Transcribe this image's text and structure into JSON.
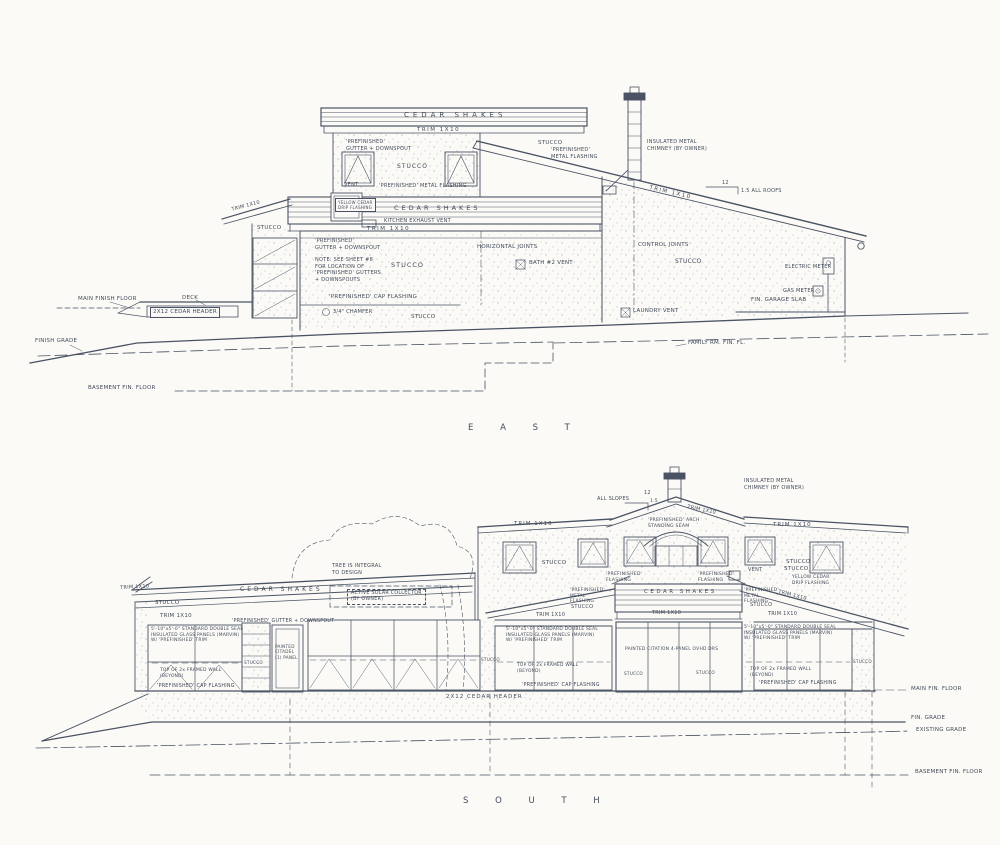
{
  "colors": {
    "paper": "#fbfaf7",
    "ink": "#4a5363",
    "text": "#424b59"
  },
  "titles": {
    "east": "E A S T",
    "south": "S O U T H"
  },
  "east": {
    "labels": [
      {
        "id": "cedar-shakes-upper",
        "t": "CEDAR SHAKES",
        "x": 404,
        "y": 111,
        "fs": 7,
        "ls": 4
      },
      {
        "id": "trim-1x10-upper",
        "t": "TRIM 1X10",
        "x": 417,
        "y": 127,
        "fs": 5.5,
        "ls": 1.5
      },
      {
        "id": "gutter-downspout-clerestory",
        "t": "'PREFINISHED'\nGUTTER + DOWNSPOUT",
        "x": 346,
        "y": 139,
        "fs": 5
      },
      {
        "id": "stucco-clerestory",
        "t": "STUCCO",
        "x": 397,
        "y": 163,
        "fs": 6,
        "ls": 1
      },
      {
        "id": "stucco-shed",
        "t": "STUCCO",
        "x": 538,
        "y": 140,
        "fs": 5.5
      },
      {
        "id": "metal-flashing-shed",
        "t": "'PREFINISHED'\nMETAL FLASHING",
        "x": 551,
        "y": 147,
        "fs": 5
      },
      {
        "id": "chimney-note",
        "t": "INSULATED METAL\nCHIMNEY (BY OWNER)",
        "x": 647,
        "y": 139,
        "fs": 5
      },
      {
        "id": "vent-clerestory",
        "t": "VENT",
        "x": 344,
        "y": 182,
        "fs": 5
      },
      {
        "id": "metal-flashing-band",
        "t": "'PREFINISHED' METAL FLASHING",
        "x": 379,
        "y": 183,
        "fs": 5
      },
      {
        "id": "trim-1x10-shed",
        "t": "TRIM 1X10",
        "x": 650,
        "y": 185,
        "fs": 5.5,
        "ls": 1.5,
        "r": 13
      },
      {
        "id": "slope-run",
        "t": "12",
        "x": 722,
        "y": 180,
        "fs": 5
      },
      {
        "id": "slope-note",
        "t": "1.5 ALL ROOFS",
        "x": 741,
        "y": 188,
        "fs": 5
      },
      {
        "id": "yellow-cedar-flashing",
        "t": "YELLOW CEDAR\nDRIP FLASHING",
        "x": 335,
        "y": 198,
        "fs": 4,
        "box": "solid"
      },
      {
        "id": "cedar-shakes-mid",
        "t": "CEDAR SHAKES",
        "x": 394,
        "y": 204,
        "fs": 6.5,
        "ls": 3
      },
      {
        "id": "kitchen-exhaust-vent",
        "t": "KITCHEN EXHAUST VENT",
        "x": 384,
        "y": 218,
        "fs": 5
      },
      {
        "id": "trim-1x10-mid",
        "t": "TRIM 1X10",
        "x": 367,
        "y": 226,
        "fs": 5.5,
        "ls": 1.5
      },
      {
        "id": "stucco-left-wing",
        "t": "STUCCO",
        "x": 257,
        "y": 225,
        "fs": 5.5
      },
      {
        "id": "trim-1x10-left-roof",
        "t": "TRIM 1X10",
        "x": 231,
        "y": 207,
        "fs": 5,
        "r": -15
      },
      {
        "id": "gutter-downspout-main",
        "t": "'PREFINISHED'\nGUTTER + DOWNSPOUT",
        "x": 315,
        "y": 238,
        "fs": 5
      },
      {
        "id": "gutter-note",
        "t": "NOTE: SEE SHEET #8\nFOR LOCATION OF\n'PREFINISHED' GUTTERS\n+ DOWNSPOUTS",
        "x": 315,
        "y": 257,
        "fs": 5
      },
      {
        "id": "stucco-main",
        "t": "STUCCO",
        "x": 391,
        "y": 261,
        "fs": 6.5,
        "ls": 1
      },
      {
        "id": "horizontal-joints",
        "t": "HORIZONTAL JOINTS",
        "x": 477,
        "y": 244,
        "fs": 5.5
      },
      {
        "id": "bath-vent",
        "t": "BATH #2 VENT",
        "x": 529,
        "y": 260,
        "fs": 5.5
      },
      {
        "id": "control-joints",
        "t": "CONTROL JOINTS",
        "x": 638,
        "y": 242,
        "fs": 5.5
      },
      {
        "id": "stucco-garage-wall",
        "t": "STUCCO",
        "x": 675,
        "y": 258,
        "fs": 6
      },
      {
        "id": "electric-meter",
        "t": "ELECTRIC METER",
        "x": 785,
        "y": 264,
        "fs": 5
      },
      {
        "id": "gas-meter",
        "t": "GAS METER",
        "x": 783,
        "y": 288,
        "fs": 5
      },
      {
        "id": "fin-garage-slab",
        "t": "FIN. GARAGE SLAB",
        "x": 751,
        "y": 297,
        "fs": 5.5
      },
      {
        "id": "cap-flashing",
        "t": "'PREFINISHED' CAP FLASHING",
        "x": 329,
        "y": 294,
        "fs": 5.5
      },
      {
        "id": "chamfer",
        "t": "3/4\" CHAMFER",
        "x": 333,
        "y": 309,
        "fs": 5
      },
      {
        "id": "stucco-base",
        "t": "STUCCO",
        "x": 411,
        "y": 314,
        "fs": 5.5
      },
      {
        "id": "main-finish-floor",
        "t": "MAIN FINISH FLOOR",
        "x": 78,
        "y": 296,
        "fs": 5.5
      },
      {
        "id": "deck",
        "t": "DECK",
        "x": 182,
        "y": 295,
        "fs": 5.5
      },
      {
        "id": "cedar-header",
        "t": "2X12 CEDAR HEADER",
        "x": 150,
        "y": 307,
        "fs": 5.5,
        "box": "solid"
      },
      {
        "id": "finish-grade",
        "t": "FINISH GRADE",
        "x": 35,
        "y": 338,
        "fs": 5.5
      },
      {
        "id": "basement-fin-floor",
        "t": "BASEMENT FIN. FLOOR",
        "x": 88,
        "y": 385,
        "fs": 5.5
      },
      {
        "id": "family-rm-fin-fl",
        "t": "FAMILY RM. FIN. FL.",
        "x": 688,
        "y": 340,
        "fs": 5.5
      },
      {
        "id": "laundry-vent",
        "t": "LAUNDRY VENT",
        "x": 633,
        "y": 308,
        "fs": 5.5
      }
    ]
  },
  "south": {
    "labels": [
      {
        "id": "chimney-note",
        "t": "INSULATED METAL\nCHIMNEY (BY OWNER)",
        "x": 744,
        "y": 478,
        "fs": 5
      },
      {
        "id": "all-slopes",
        "t": "ALL SLOPES",
        "x": 597,
        "y": 496,
        "fs": 5
      },
      {
        "id": "slope-run",
        "t": "12",
        "x": 644,
        "y": 490,
        "fs": 5
      },
      {
        "id": "slope-rise",
        "t": "1.5",
        "x": 650,
        "y": 499,
        "fs": 4.5
      },
      {
        "id": "trim-1x10-rake",
        "t": "TRIM 1X10",
        "x": 688,
        "y": 504,
        "fs": 5,
        "r": 12
      },
      {
        "id": "arch-standing-seam",
        "t": "'PREFINISHED' ARCH\nSTANDING SEAM",
        "x": 648,
        "y": 518,
        "fs": 4.6
      },
      {
        "id": "trim-1x10-band-left",
        "t": "TRIM 1X10",
        "x": 514,
        "y": 521,
        "fs": 5.5,
        "ls": 1
      },
      {
        "id": "trim-1x10-band-right",
        "t": "TRIM 1X10",
        "x": 773,
        "y": 522,
        "fs": 5.5,
        "ls": 1
      },
      {
        "id": "stucco-upper-left",
        "t": "STUCCO",
        "x": 542,
        "y": 560,
        "fs": 5.5
      },
      {
        "id": "stucco-upper-right",
        "t": "STUCCO",
        "x": 786,
        "y": 559,
        "fs": 5.5
      },
      {
        "id": "tree-note",
        "t": "TREE IS INTEGRAL\nTO DESIGN",
        "x": 332,
        "y": 563,
        "fs": 5
      },
      {
        "id": "cedar-shakes-left",
        "t": "CEDAR SHAKES",
        "x": 240,
        "y": 586,
        "fs": 6,
        "ls": 3
      },
      {
        "id": "solar-collector",
        "t": "ACTIVE SOLAR COLLECTOR\n(BY OWNER)",
        "x": 347,
        "y": 589,
        "fs": 4.8,
        "box": "dashed"
      },
      {
        "id": "trim-1x10-left-roof",
        "t": "TRIM 1X10",
        "x": 120,
        "y": 585,
        "fs": 5,
        "r": -3
      },
      {
        "id": "stucco-left",
        "t": "STUCCO",
        "x": 155,
        "y": 600,
        "fs": 5.5
      },
      {
        "id": "trim-1x10-left-wall",
        "t": "TRIM 1X10",
        "x": 160,
        "y": 613,
        "fs": 5.5
      },
      {
        "id": "prefin-flashing-left",
        "t": "'PREFINISHED'\nFLASHING",
        "x": 606,
        "y": 572,
        "fs": 4.6
      },
      {
        "id": "prefin-flashing-right",
        "t": "'PREFINISHED'\nFLASHING",
        "x": 698,
        "y": 572,
        "fs": 4.6
      },
      {
        "id": "vent",
        "t": "VENT",
        "x": 748,
        "y": 567,
        "fs": 5
      },
      {
        "id": "stucco-right-upper",
        "t": "STUCCO",
        "x": 784,
        "y": 566,
        "fs": 5.5
      },
      {
        "id": "yellow-cedar-flashing",
        "t": "YELLOW CEDAR\nDRIP FLASHING",
        "x": 792,
        "y": 575,
        "fs": 4.4
      },
      {
        "id": "trim-1x10-right-roof",
        "t": "TRIM 1X10",
        "x": 779,
        "y": 589,
        "fs": 5,
        "r": 14
      },
      {
        "id": "metal-flashing-left",
        "t": "'PREFINISHED'\nMETAL\nFLASHING",
        "x": 570,
        "y": 588,
        "fs": 4.4
      },
      {
        "id": "cedar-shakes-garage",
        "t": "CEDAR SHAKES",
        "x": 644,
        "y": 589,
        "fs": 5.5,
        "ls": 2.5
      },
      {
        "id": "metal-flashing-right",
        "t": "'PREFINISHED'\nMETAL\nFLASHING",
        "x": 744,
        "y": 588,
        "fs": 4.4
      },
      {
        "id": "stucco-mid-left",
        "t": "STUCCO",
        "x": 571,
        "y": 604,
        "fs": 5
      },
      {
        "id": "stucco-mid-right",
        "t": "STUCCO",
        "x": 750,
        "y": 602,
        "fs": 5
      },
      {
        "id": "trim-1x10-garage",
        "t": "TRIM 1X10",
        "x": 652,
        "y": 610,
        "fs": 5
      },
      {
        "id": "trim-1x10-mid",
        "t": "TRIM 1X10",
        "x": 536,
        "y": 612,
        "fs": 5
      },
      {
        "id": "trim-1x10-right-band",
        "t": "TRIM 1X10",
        "x": 768,
        "y": 611,
        "fs": 5
      },
      {
        "id": "gutter-downspout",
        "t": "'PREFINISHED' GUTTER + DOWNSPOUT",
        "x": 232,
        "y": 619,
        "fs": 4.8
      },
      {
        "id": "glass-spec-left",
        "t": "5'-10\"x5'-0\" STANDARD DOUBLE SEAL\nINSULATED GLASS PANELS (MARVIN)\nW/ 'PREFINISHED' TRIM",
        "x": 151,
        "y": 627,
        "fs": 4.4
      },
      {
        "id": "glass-spec-center",
        "t": "5'-10\"x5'-0\" STANDARD DOUBLE SEAL\nINSULATED GLASS PANELS (MARVIN)\nW/ 'PREFINISHED' TRIM",
        "x": 506,
        "y": 627,
        "fs": 4.4
      },
      {
        "id": "glass-spec-right",
        "t": "5'-10\"x5'-0\" STANDARD DOUBLE SEAL\nINSULATED GLASS PANELS (MARVIN)\nW/ 'PREFINISHED' TRIM",
        "x": 744,
        "y": 625,
        "fs": 4.4
      },
      {
        "id": "door-label",
        "t": "PAINTED\nCITADEL\n(1) PANEL",
        "x": 275,
        "y": 644,
        "fs": 4.2
      },
      {
        "id": "stucco-pier-left",
        "t": "STUCCO",
        "x": 244,
        "y": 660,
        "fs": 4.2
      },
      {
        "id": "stucco-pier-mid",
        "t": "STUCCO",
        "x": 481,
        "y": 657,
        "fs": 4.2
      },
      {
        "id": "garage-door-label",
        "t": "PAINTED CITATION 4-PANEL OVHD DRS",
        "x": 625,
        "y": 647,
        "fs": 4.4
      },
      {
        "id": "stucco-garage-left",
        "t": "STUCCO",
        "x": 624,
        "y": 671,
        "fs": 4.2
      },
      {
        "id": "stucco-garage-right",
        "t": "STUCCO",
        "x": 696,
        "y": 670,
        "fs": 4.2
      },
      {
        "id": "stucco-pier-right",
        "t": "STUCCO",
        "x": 853,
        "y": 659,
        "fs": 4.2
      },
      {
        "id": "top-of-wall-left",
        "t": "TOP OF 2x FRAMED WALL\n(BEYOND)",
        "x": 160,
        "y": 668,
        "fs": 4.4
      },
      {
        "id": "top-of-wall-center",
        "t": "TOP OF 2x FRAMED WALL\n(BEYOND)",
        "x": 517,
        "y": 663,
        "fs": 4.4
      },
      {
        "id": "top-of-wall-right",
        "t": "TOP OF 2x FRAMED WALL\n(BEYOND)",
        "x": 750,
        "y": 667,
        "fs": 4.4
      },
      {
        "id": "cap-flashing-left",
        "t": "'PREFINISHED' CAP FLASHING",
        "x": 157,
        "y": 684,
        "fs": 4.8
      },
      {
        "id": "cap-flashing-center",
        "t": "'PREFINISHED' CAP FLASHING",
        "x": 522,
        "y": 683,
        "fs": 4.8
      },
      {
        "id": "cap-flashing-right",
        "t": "'PREFINISHED' CAP FLASHING",
        "x": 759,
        "y": 681,
        "fs": 4.8
      },
      {
        "id": "cedar-header",
        "t": "2X12 CEDAR HEADER",
        "x": 446,
        "y": 694,
        "fs": 5.5,
        "ls": 1
      },
      {
        "id": "main-fin-floor",
        "t": "MAIN FIN. FLOOR",
        "x": 911,
        "y": 686,
        "fs": 5.5
      },
      {
        "id": "fin-grade",
        "t": "FIN. GRADE",
        "x": 911,
        "y": 715,
        "fs": 5.5
      },
      {
        "id": "existing-grade",
        "t": "EXISTING GRADE",
        "x": 916,
        "y": 727,
        "fs": 5.5
      },
      {
        "id": "basement-fin-floor",
        "t": "BASEMENT FIN. FLOOR",
        "x": 915,
        "y": 769,
        "fs": 5.5
      }
    ]
  }
}
